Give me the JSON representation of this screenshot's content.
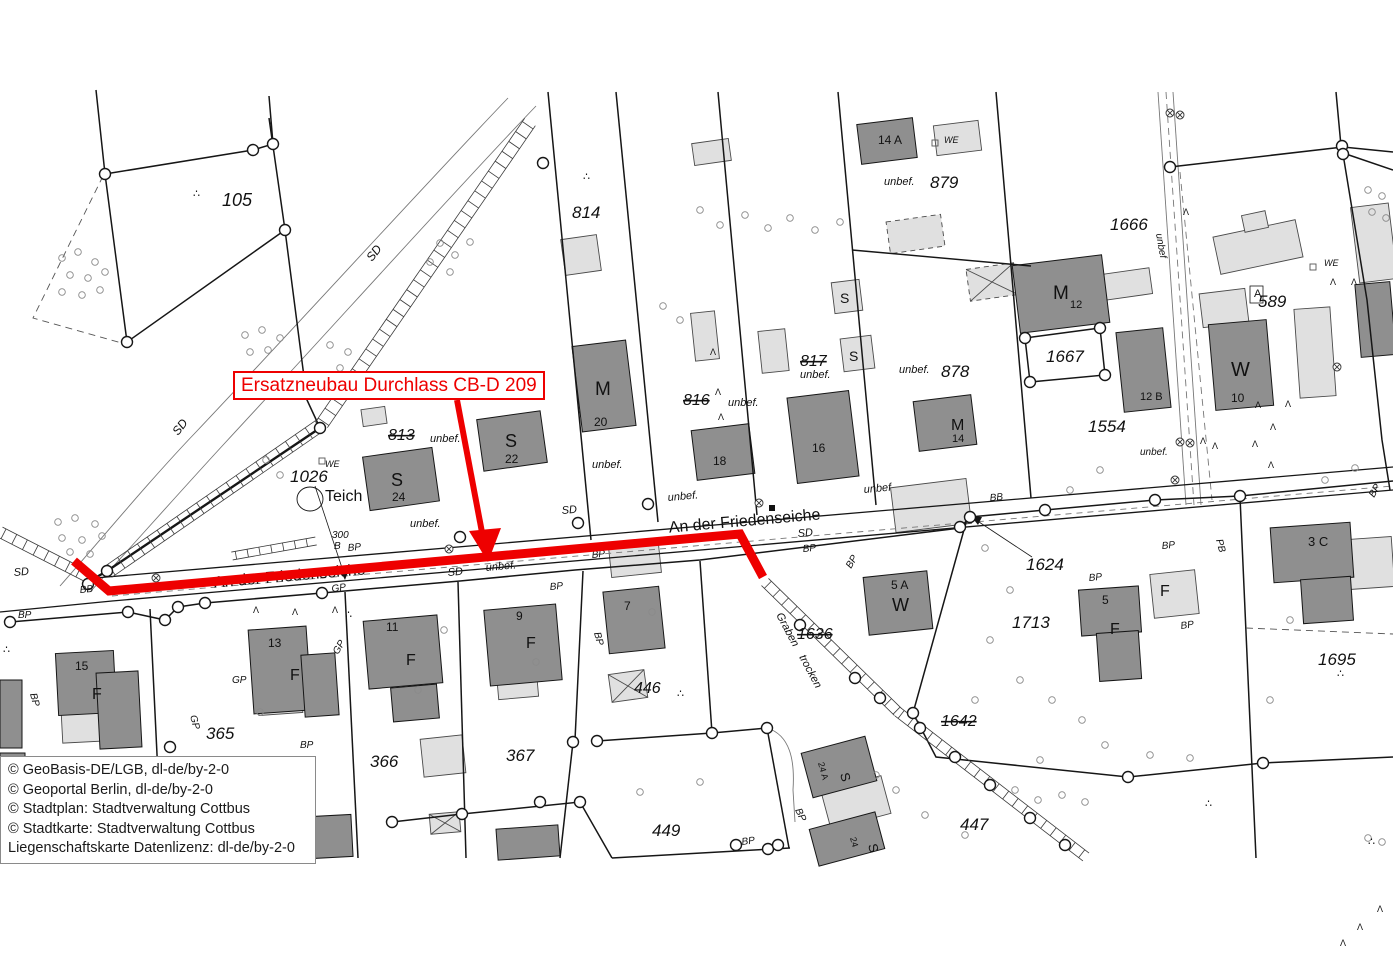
{
  "annotation": {
    "label": "Ersatzneubau Durchlass CB-D 209",
    "color": "#ee0000"
  },
  "attribution": {
    "lines": [
      "© GeoBasis-DE/LGB, dl-de/by-2-0",
      "© Geoportal Berlin, dl-de/by-2-0",
      "© Stadtplan: Stadtverwaltung Cottbus",
      "© Stadtkarte: Stadtverwaltung Cottbus",
      "Liegenschaftskarte Datenlizenz: dl-de/by-2-0"
    ]
  },
  "street_name": "An der Friedenseiche",
  "map": {
    "labels": [
      {
        "t": "105",
        "x": 222,
        "y": 206,
        "s": 18,
        "i": 1
      },
      {
        "t": "SD",
        "x": 372,
        "y": 262,
        "s": 12,
        "i": 1,
        "r": -52
      },
      {
        "t": "SD",
        "x": 178,
        "y": 436,
        "s": 12,
        "i": 1,
        "r": -52
      },
      {
        "t": "814",
        "x": 572,
        "y": 218,
        "s": 17,
        "i": 1
      },
      {
        "t": "816",
        "x": 683,
        "y": 405,
        "s": 16,
        "i": 1,
        "st": 1
      },
      {
        "t": "unbef.",
        "x": 728,
        "y": 406,
        "s": 11,
        "i": 1
      },
      {
        "t": "817",
        "x": 800,
        "y": 366,
        "s": 16,
        "i": 1,
        "st": 1
      },
      {
        "t": "unbef.",
        "x": 800,
        "y": 378,
        "s": 11,
        "i": 1
      },
      {
        "t": "879",
        "x": 930,
        "y": 188,
        "s": 17,
        "i": 1
      },
      {
        "t": "unbef.",
        "x": 884,
        "y": 185,
        "s": 11,
        "i": 1
      },
      {
        "t": "14 A",
        "x": 878,
        "y": 144,
        "s": 12
      },
      {
        "t": "WE",
        "x": 944,
        "y": 143,
        "s": 9,
        "i": 1
      },
      {
        "t": "878",
        "x": 941,
        "y": 377,
        "s": 17,
        "i": 1
      },
      {
        "t": "unbef.",
        "x": 899,
        "y": 373,
        "s": 11,
        "i": 1
      },
      {
        "t": "1666",
        "x": 1110,
        "y": 230,
        "s": 17,
        "i": 1
      },
      {
        "t": "unbef",
        "x": 1156,
        "y": 234,
        "s": 10,
        "i": 1,
        "r": 80
      },
      {
        "t": "1667",
        "x": 1046,
        "y": 362,
        "s": 17,
        "i": 1
      },
      {
        "t": "1554",
        "x": 1088,
        "y": 432,
        "s": 17,
        "i": 1
      },
      {
        "t": "unbef.",
        "x": 1140,
        "y": 455,
        "s": 10,
        "i": 1
      },
      {
        "t": "589",
        "x": 1258,
        "y": 307,
        "s": 17,
        "i": 1
      },
      {
        "t": "A",
        "x": 1254,
        "y": 297,
        "s": 11
      },
      {
        "t": "WE",
        "x": 1324,
        "y": 266,
        "s": 9,
        "i": 1
      },
      {
        "t": "M",
        "x": 595,
        "y": 395,
        "s": 19
      },
      {
        "t": "20",
        "x": 594,
        "y": 426,
        "s": 12
      },
      {
        "t": "S",
        "x": 505,
        "y": 447,
        "s": 18
      },
      {
        "t": "22",
        "x": 505,
        "y": 463,
        "s": 12
      },
      {
        "t": "S",
        "x": 391,
        "y": 486,
        "s": 18
      },
      {
        "t": "24",
        "x": 392,
        "y": 501,
        "s": 12
      },
      {
        "t": "18",
        "x": 713,
        "y": 465,
        "s": 12
      },
      {
        "t": "16",
        "x": 812,
        "y": 452,
        "s": 12
      },
      {
        "t": "S",
        "x": 840,
        "y": 303,
        "s": 14
      },
      {
        "t": "S",
        "x": 849,
        "y": 361,
        "s": 14
      },
      {
        "t": "M",
        "x": 1053,
        "y": 299,
        "s": 19
      },
      {
        "t": "12",
        "x": 1070,
        "y": 308,
        "s": 11
      },
      {
        "t": "12 B",
        "x": 1140,
        "y": 400,
        "s": 11
      },
      {
        "t": "M",
        "x": 951,
        "y": 430,
        "s": 16
      },
      {
        "t": "14",
        "x": 952,
        "y": 442,
        "s": 11
      },
      {
        "t": "W",
        "x": 1231,
        "y": 376,
        "s": 20
      },
      {
        "t": "10",
        "x": 1231,
        "y": 402,
        "s": 12
      },
      {
        "t": "813",
        "x": 388,
        "y": 440,
        "s": 16,
        "i": 1,
        "st": 1
      },
      {
        "t": "unbef.",
        "x": 430,
        "y": 442,
        "s": 11,
        "i": 1
      },
      {
        "t": "1026",
        "x": 290,
        "y": 482,
        "s": 17,
        "i": 1
      },
      {
        "t": "WE",
        "x": 325,
        "y": 467,
        "s": 9,
        "i": 1
      },
      {
        "t": "Teich",
        "x": 325,
        "y": 501,
        "s": 16
      },
      {
        "t": "300",
        "x": 332,
        "y": 538,
        "s": 10,
        "i": 1
      },
      {
        "t": "B",
        "x": 334,
        "y": 549,
        "s": 10,
        "i": 1
      },
      {
        "t": "An der Friedenseiche",
        "x": 290,
        "y": 581,
        "s": 16,
        "r": -5,
        "a": "m"
      },
      {
        "t": "An der Friedenseiche",
        "x": 745,
        "y": 526,
        "s": 16,
        "r": -5,
        "a": "m"
      },
      {
        "t": "SD",
        "x": 14,
        "y": 576,
        "s": 11,
        "i": 1,
        "r": -5
      },
      {
        "t": "BB",
        "x": 80,
        "y": 593,
        "s": 10,
        "i": 1,
        "r": -5
      },
      {
        "t": "BP",
        "x": 18,
        "y": 618,
        "s": 10,
        "i": 1
      },
      {
        "t": "BP",
        "x": 348,
        "y": 551,
        "s": 10,
        "i": 1,
        "r": -5
      },
      {
        "t": "GP",
        "x": 332,
        "y": 592,
        "s": 10,
        "i": 1,
        "r": -8
      },
      {
        "t": "SD",
        "x": 448,
        "y": 576,
        "s": 11,
        "i": 1,
        "r": -5
      },
      {
        "t": "unbef.",
        "x": 486,
        "y": 571,
        "s": 11,
        "i": 1,
        "r": -5
      },
      {
        "t": "BP",
        "x": 550,
        "y": 590,
        "s": 10,
        "i": 1,
        "r": -5
      },
      {
        "t": "SD",
        "x": 562,
        "y": 514,
        "s": 11,
        "i": 1,
        "r": -5
      },
      {
        "t": "BP",
        "x": 592,
        "y": 558,
        "s": 10,
        "i": 1,
        "r": -5
      },
      {
        "t": "SD",
        "x": 798,
        "y": 537,
        "s": 11,
        "i": 1,
        "r": -5
      },
      {
        "t": "BP",
        "x": 803,
        "y": 552,
        "s": 10,
        "i": 1,
        "r": -5
      },
      {
        "t": "unbef",
        "x": 864,
        "y": 493,
        "s": 11,
        "i": 1,
        "r": -5
      },
      {
        "t": "BB",
        "x": 990,
        "y": 501,
        "s": 10,
        "i": 1,
        "r": -5
      },
      {
        "t": "BP",
        "x": 851,
        "y": 569,
        "s": 10,
        "i": 1,
        "r": -60
      },
      {
        "t": "1624",
        "x": 1026,
        "y": 570,
        "s": 17,
        "i": 1
      },
      {
        "t": "BP",
        "x": 1162,
        "y": 549,
        "s": 10,
        "i": 1,
        "r": -5
      },
      {
        "t": "PB",
        "x": 1216,
        "y": 540,
        "s": 10,
        "i": 1,
        "r": 75
      },
      {
        "t": "BP",
        "x": 1089,
        "y": 581,
        "s": 10,
        "i": 1,
        "r": -5
      },
      {
        "t": "BP",
        "x": 1181,
        "y": 629,
        "s": 10,
        "i": 1,
        "r": -8
      },
      {
        "t": "BP",
        "x": 1374,
        "y": 498,
        "s": 10,
        "i": 1,
        "r": -60
      },
      {
        "t": "15",
        "x": 75,
        "y": 670,
        "s": 12
      },
      {
        "t": "F",
        "x": 92,
        "y": 699,
        "s": 16
      },
      {
        "t": "BP",
        "x": 30,
        "y": 694,
        "s": 10,
        "i": 1,
        "r": 75
      },
      {
        "t": "13",
        "x": 268,
        "y": 647,
        "s": 12
      },
      {
        "t": "F",
        "x": 290,
        "y": 680,
        "s": 16
      },
      {
        "t": "365",
        "x": 206,
        "y": 739,
        "s": 17,
        "i": 1
      },
      {
        "t": "366",
        "x": 370,
        "y": 767,
        "s": 17,
        "i": 1
      },
      {
        "t": "367",
        "x": 506,
        "y": 761,
        "s": 17,
        "i": 1
      },
      {
        "t": "GP",
        "x": 232,
        "y": 683,
        "s": 10,
        "i": 1
      },
      {
        "t": "GP",
        "x": 338,
        "y": 655,
        "s": 10,
        "i": 1,
        "r": -60
      },
      {
        "t": "BP",
        "x": 300,
        "y": 748,
        "s": 10,
        "i": 1
      },
      {
        "t": "GP",
        "x": 190,
        "y": 716,
        "s": 10,
        "i": 1,
        "r": 75
      },
      {
        "t": "11",
        "x": 386,
        "y": 631,
        "s": 12
      },
      {
        "t": "F",
        "x": 406,
        "y": 665,
        "s": 16
      },
      {
        "t": "9",
        "x": 516,
        "y": 620,
        "s": 12
      },
      {
        "t": "F",
        "x": 526,
        "y": 648,
        "s": 16
      },
      {
        "t": "7",
        "x": 624,
        "y": 610,
        "s": 12
      },
      {
        "t": "BP",
        "x": 594,
        "y": 633,
        "s": 10,
        "i": 1,
        "r": 75
      },
      {
        "t": "446",
        "x": 634,
        "y": 693,
        "s": 16,
        "i": 1
      },
      {
        "t": "449",
        "x": 652,
        "y": 836,
        "s": 17,
        "i": 1
      },
      {
        "t": "BP",
        "x": 742,
        "y": 845,
        "s": 10,
        "i": 1,
        "r": -8
      },
      {
        "t": "5 A",
        "x": 891,
        "y": 589,
        "s": 12
      },
      {
        "t": "W",
        "x": 892,
        "y": 611,
        "s": 18
      },
      {
        "t": "1636",
        "x": 797,
        "y": 639,
        "s": 16,
        "i": 1,
        "st": 1
      },
      {
        "t": "Graben",
        "x": 776,
        "y": 615,
        "s": 11,
        "i": 1,
        "r": 62
      },
      {
        "t": "trocken",
        "x": 799,
        "y": 657,
        "s": 11,
        "i": 1,
        "r": 62
      },
      {
        "t": "1713",
        "x": 1012,
        "y": 628,
        "s": 17,
        "i": 1
      },
      {
        "t": "1642",
        "x": 941,
        "y": 726,
        "s": 16,
        "i": 1,
        "st": 1
      },
      {
        "t": "447",
        "x": 960,
        "y": 830,
        "s": 17,
        "i": 1
      },
      {
        "t": "1695",
        "x": 1318,
        "y": 665,
        "s": 17,
        "i": 1
      },
      {
        "t": "3 C",
        "x": 1308,
        "y": 546,
        "s": 13
      },
      {
        "t": "5",
        "x": 1102,
        "y": 604,
        "s": 12
      },
      {
        "t": "F",
        "x": 1110,
        "y": 634,
        "s": 16
      },
      {
        "t": "F",
        "x": 1160,
        "y": 596,
        "s": 16
      },
      {
        "t": "S",
        "x": 840,
        "y": 774,
        "s": 13,
        "r": 75
      },
      {
        "t": "24 A",
        "x": 818,
        "y": 763,
        "s": 9,
        "r": 75
      },
      {
        "t": "S",
        "x": 868,
        "y": 845,
        "s": 13,
        "r": 75
      },
      {
        "t": "24",
        "x": 850,
        "y": 838,
        "s": 9,
        "r": 75
      },
      {
        "t": "BP",
        "x": 795,
        "y": 810,
        "s": 10,
        "i": 1,
        "r": 65
      },
      {
        "t": "unbef.",
        "x": 668,
        "y": 501,
        "s": 11,
        "i": 1,
        "r": -5
      },
      {
        "t": "unbef.",
        "x": 592,
        "y": 468,
        "s": 11,
        "i": 1
      },
      {
        "t": "unbef.",
        "x": 410,
        "y": 527,
        "s": 11,
        "i": 1
      }
    ],
    "vertex_circles": [
      [
        253,
        150
      ],
      [
        273,
        144
      ],
      [
        105,
        174
      ],
      [
        127,
        342
      ],
      [
        285,
        230
      ],
      [
        320,
        428
      ],
      [
        107,
        571
      ],
      [
        543,
        163
      ],
      [
        460,
        537
      ],
      [
        578,
        523
      ],
      [
        648,
        504
      ],
      [
        960,
        527
      ],
      [
        970,
        517
      ],
      [
        1045,
        510
      ],
      [
        1155,
        500
      ],
      [
        1240,
        496
      ],
      [
        1342,
        146
      ],
      [
        1343,
        154
      ],
      [
        1170,
        167
      ],
      [
        1025,
        338
      ],
      [
        1100,
        328
      ],
      [
        1030,
        382
      ],
      [
        1105,
        375
      ],
      [
        128,
        612
      ],
      [
        165,
        620
      ],
      [
        178,
        607
      ],
      [
        205,
        603
      ],
      [
        322,
        593
      ],
      [
        392,
        822
      ],
      [
        462,
        814
      ],
      [
        580,
        802
      ],
      [
        573,
        742
      ],
      [
        597,
        741
      ],
      [
        712,
        733
      ],
      [
        767,
        728
      ],
      [
        913,
        713
      ],
      [
        1128,
        777
      ],
      [
        1263,
        763
      ],
      [
        540,
        802
      ],
      [
        170,
        747
      ],
      [
        10,
        622
      ],
      [
        736,
        845
      ],
      [
        768,
        849
      ],
      [
        778,
        845
      ],
      [
        800,
        625
      ],
      [
        855,
        678
      ],
      [
        880,
        698
      ],
      [
        920,
        728
      ],
      [
        955,
        757
      ],
      [
        990,
        785
      ],
      [
        1030,
        818
      ],
      [
        1065,
        845
      ],
      [
        88,
        584
      ]
    ],
    "bushes": [
      [
        62,
        258
      ],
      [
        78,
        252
      ],
      [
        95,
        262
      ],
      [
        70,
        275
      ],
      [
        88,
        278
      ],
      [
        105,
        272
      ],
      [
        62,
        292
      ],
      [
        82,
        295
      ],
      [
        100,
        290
      ],
      [
        245,
        335
      ],
      [
        262,
        330
      ],
      [
        280,
        338
      ],
      [
        250,
        352
      ],
      [
        268,
        350
      ],
      [
        330,
        345
      ],
      [
        348,
        352
      ],
      [
        340,
        368
      ],
      [
        58,
        522
      ],
      [
        75,
        518
      ],
      [
        95,
        524
      ],
      [
        62,
        538
      ],
      [
        82,
        540
      ],
      [
        102,
        536
      ],
      [
        70,
        552
      ],
      [
        90,
        554
      ],
      [
        280,
        475
      ],
      [
        266,
        460
      ],
      [
        985,
        548
      ],
      [
        1010,
        590
      ],
      [
        990,
        640
      ],
      [
        1020,
        680
      ],
      [
        1052,
        700
      ],
      [
        1082,
        720
      ],
      [
        1105,
        745
      ],
      [
        1150,
        755
      ],
      [
        1190,
        758
      ],
      [
        1040,
        760
      ],
      [
        975,
        700
      ],
      [
        925,
        815
      ],
      [
        1015,
        790
      ],
      [
        1038,
        800
      ],
      [
        1062,
        795
      ],
      [
        1085,
        802
      ],
      [
        965,
        835
      ],
      [
        896,
        790
      ],
      [
        876,
        775
      ],
      [
        640,
        792
      ],
      [
        700,
        782
      ],
      [
        1290,
        620
      ],
      [
        1270,
        700
      ],
      [
        1325,
        480
      ],
      [
        1355,
        468
      ],
      [
        536,
        662
      ],
      [
        260,
        712
      ],
      [
        418,
        690
      ],
      [
        652,
        612
      ],
      [
        444,
        630
      ],
      [
        1070,
        490
      ],
      [
        1100,
        470
      ],
      [
        663,
        306
      ],
      [
        680,
        320
      ],
      [
        700,
        210
      ],
      [
        720,
        225
      ],
      [
        745,
        215
      ],
      [
        768,
        228
      ],
      [
        790,
        218
      ],
      [
        815,
        230
      ],
      [
        840,
        222
      ],
      [
        440,
        243
      ],
      [
        455,
        255
      ],
      [
        470,
        242
      ],
      [
        430,
        262
      ],
      [
        450,
        272
      ],
      [
        1368,
        190
      ],
      [
        1382,
        196
      ],
      [
        1372,
        212
      ],
      [
        1386,
        218
      ],
      [
        1368,
        838
      ],
      [
        1382,
        842
      ]
    ],
    "grass": [
      [
        710,
        355
      ],
      [
        715,
        395
      ],
      [
        718,
        420
      ],
      [
        1255,
        408
      ],
      [
        1285,
        407
      ],
      [
        1270,
        430
      ],
      [
        1252,
        447
      ],
      [
        1268,
        468
      ],
      [
        1330,
        285
      ],
      [
        1351,
        285
      ],
      [
        1183,
        215
      ],
      [
        253,
        613
      ],
      [
        292,
        615
      ],
      [
        332,
        613
      ],
      [
        1200,
        444
      ],
      [
        1212,
        449
      ],
      [
        1357,
        930
      ],
      [
        1377,
        912
      ],
      [
        1340,
        946
      ]
    ],
    "cross_circles": [
      [
        156,
        578
      ],
      [
        449,
        549
      ],
      [
        759,
        503
      ],
      [
        1175,
        480
      ],
      [
        1180,
        442
      ],
      [
        1190,
        443
      ],
      [
        1337,
        367
      ],
      [
        1170,
        113
      ],
      [
        1180,
        115
      ]
    ],
    "dot_triples": [
      [
        193,
        197
      ],
      [
        583,
        180
      ],
      [
        345,
        618
      ],
      [
        677,
        697
      ],
      [
        1337,
        677
      ],
      [
        1205,
        807
      ],
      [
        1368,
        845
      ],
      [
        3,
        653
      ]
    ],
    "squares_filled": [
      [
        772,
        508
      ]
    ],
    "squares_small": [
      [
        935,
        143
      ],
      [
        1313,
        267
      ],
      [
        322,
        461
      ]
    ]
  }
}
